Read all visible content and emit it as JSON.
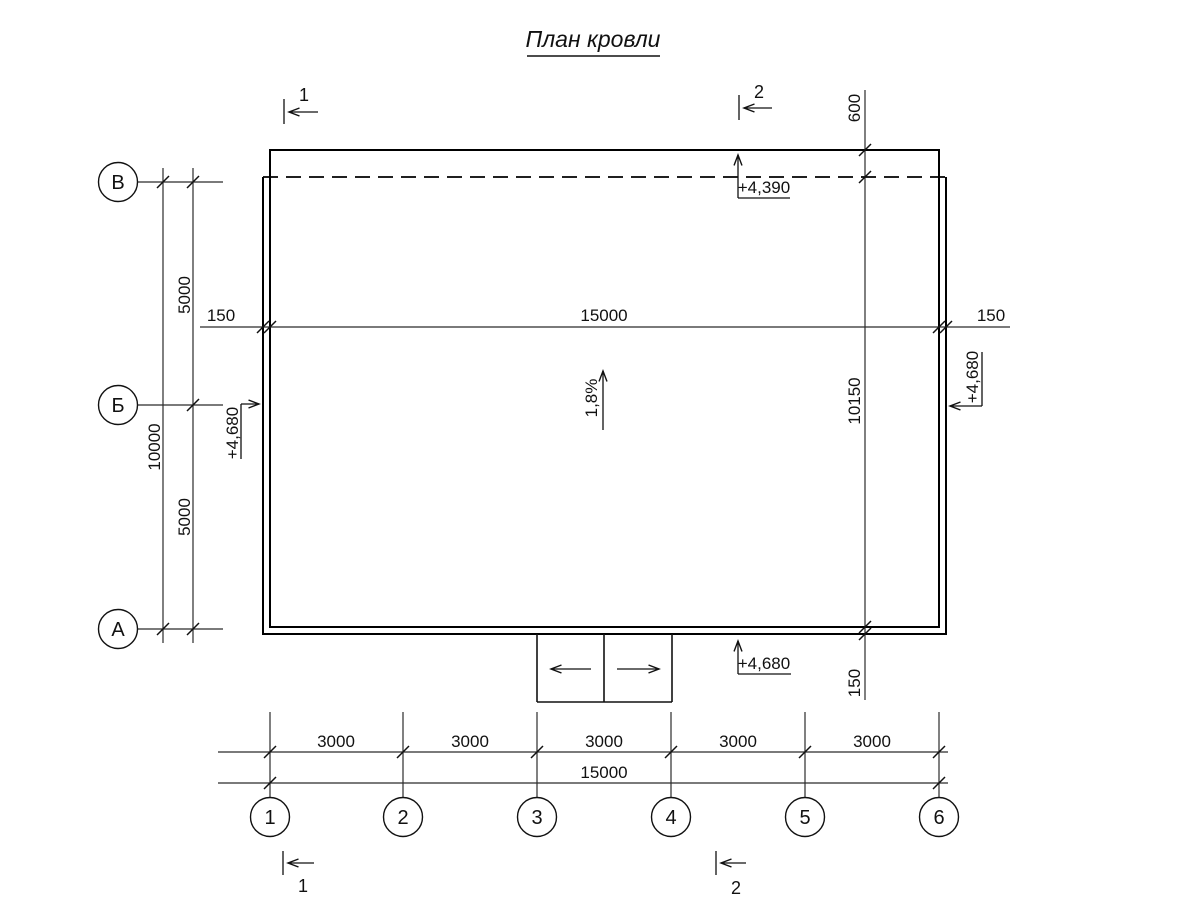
{
  "title": "План кровли",
  "colors": {
    "line": "#000000",
    "dim": "#2b2b2b",
    "background": "#ffffff"
  },
  "axes": {
    "rows": [
      "В",
      "Б",
      "А"
    ],
    "columns": [
      "1",
      "2",
      "3",
      "4",
      "5",
      "6"
    ]
  },
  "dimensions": {
    "left_total": "10000",
    "left_spans": [
      "5000",
      "5000"
    ],
    "middle": {
      "left_overhang": "150",
      "span": "15000",
      "right_overhang": "150"
    },
    "right": {
      "top_overhang": "600",
      "span": "10150",
      "bottom_overhang": "150"
    },
    "bottom": {
      "bays": [
        "3000",
        "3000",
        "3000",
        "3000",
        "3000"
      ],
      "total": "15000"
    }
  },
  "elevations": {
    "top": "+4,390",
    "left": "+4,680",
    "right": "+4,680",
    "bottom": "+4,680"
  },
  "slope": "1,8%",
  "sections": {
    "top_left": "1",
    "top_right": "2",
    "bottom_left": "1",
    "bottom_right": "2"
  }
}
